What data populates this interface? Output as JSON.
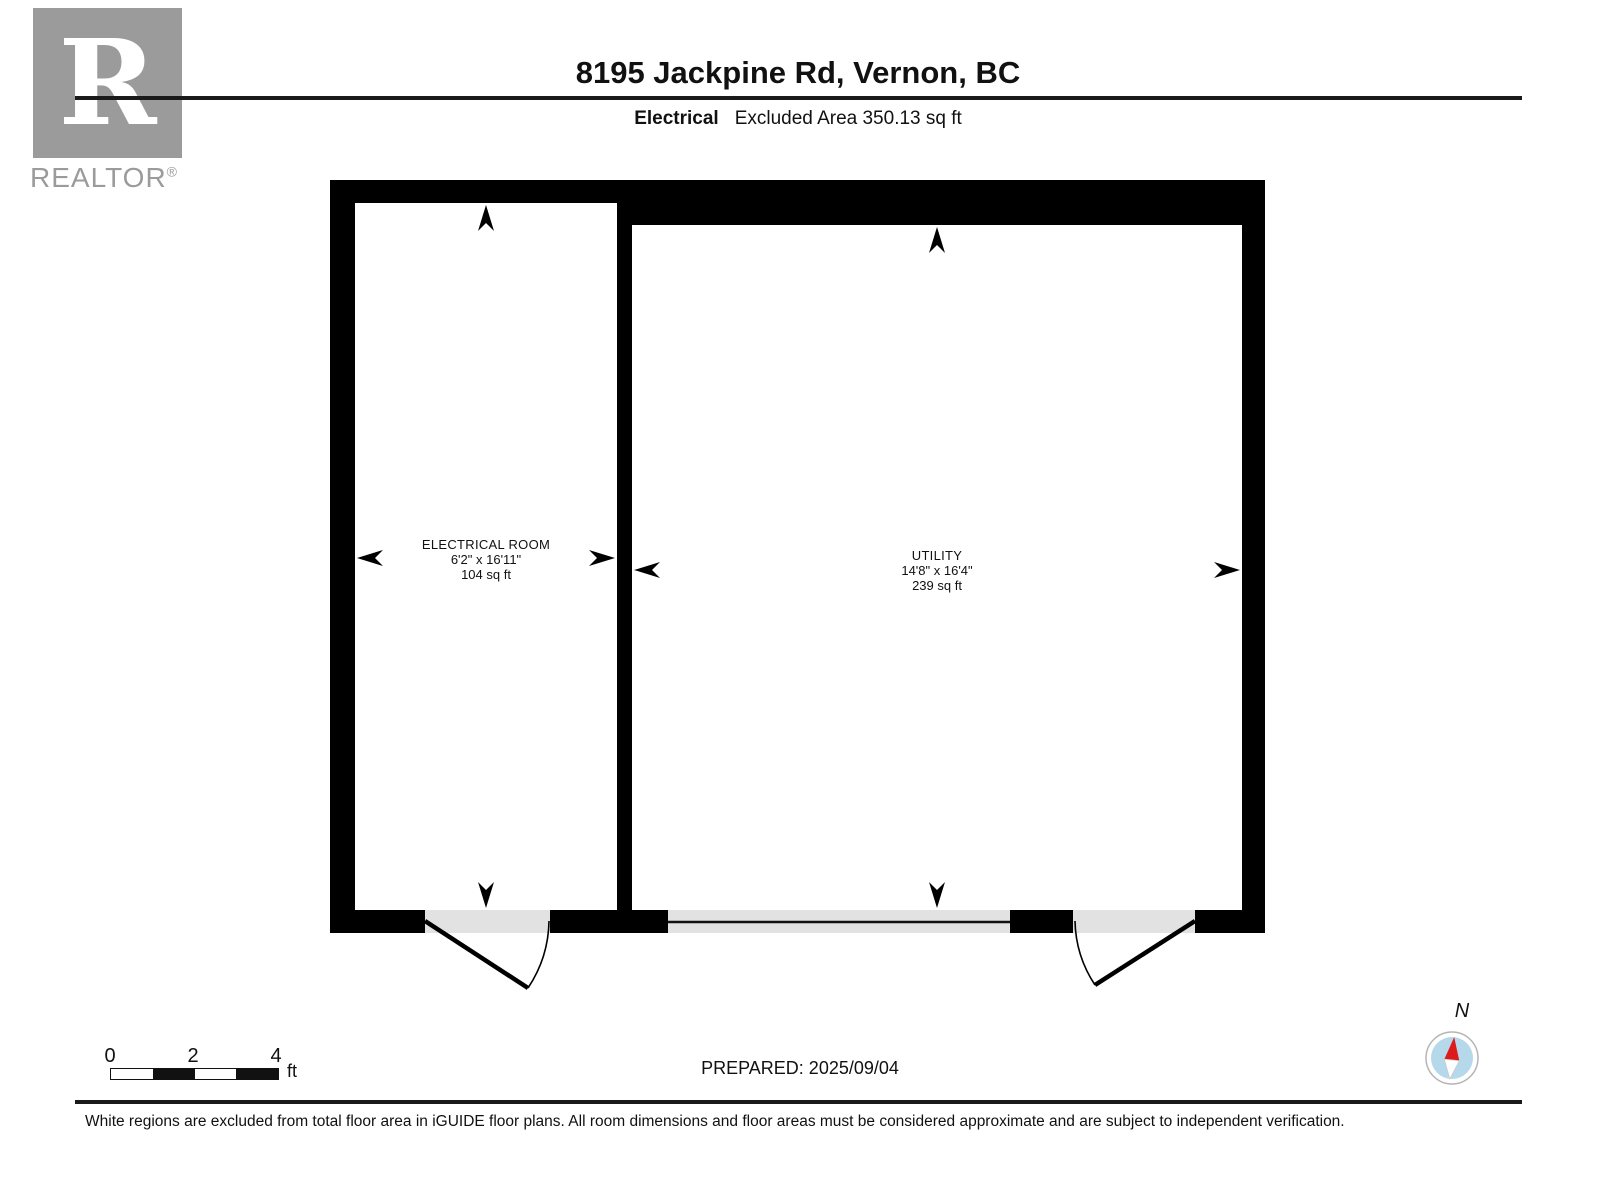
{
  "header": {
    "title": "8195 Jackpine Rd, Vernon, BC",
    "floor_label": "Electrical",
    "excluded_area": "Excluded Area 350.13 sq ft"
  },
  "logo": {
    "letter": "R",
    "word": "REALTOR",
    "registered": "®"
  },
  "rooms": [
    {
      "name": "ELECTRICAL ROOM",
      "dimensions": "6'2\" x 16'11\"",
      "area": "104 sq ft"
    },
    {
      "name": "UTILITY",
      "dimensions": "14'8\" x 16'4\"",
      "area": "239 sq ft"
    }
  ],
  "scale_bar": {
    "labels": [
      "0",
      "2",
      "4"
    ],
    "unit": "ft"
  },
  "compass": {
    "label": "N"
  },
  "footer": {
    "prepared": "PREPARED: 2025/09/04",
    "disclaimer": "White regions are excluded from total floor area in iGUIDE floor plans. All room dimensions and floor areas must be considered approximate and are subject to independent verification."
  },
  "colors": {
    "wall": "#000000",
    "opening": "#e2e2e2",
    "logo_gray": "#9b9b9b",
    "compass_blue": "#b5d8ea",
    "needle_red": "#dd1b1b"
  }
}
